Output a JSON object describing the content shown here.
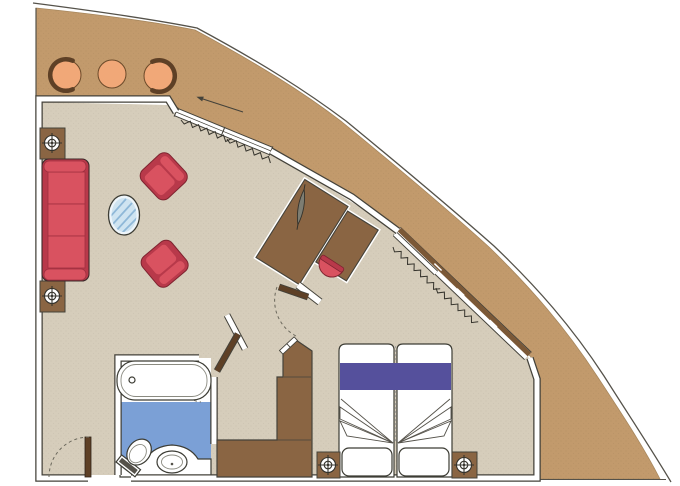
{
  "plan": {
    "kind": "suite-floor-plan",
    "rooms": [
      {
        "name": "balcony",
        "furniture": [
          "lounge-chair",
          "round-table",
          "lounge-chair"
        ]
      },
      {
        "name": "living-room",
        "furniture": [
          "sofa",
          "side-table-with-lamp",
          "side-table-with-lamp",
          "oval-glass-coffee-table",
          "armchair",
          "armchair"
        ]
      },
      {
        "name": "work-area",
        "furniture": [
          "desk-cabinet-unit",
          "tv",
          "desk-chair"
        ]
      },
      {
        "name": "bathroom",
        "furniture": [
          "bathtub",
          "toilet",
          "sink-vanity"
        ]
      },
      {
        "name": "bedroom",
        "furniture": [
          "double-bed",
          "pillow",
          "pillow",
          "nightstand-with-lamp",
          "nightstand-with-lamp",
          "wardrobe"
        ]
      }
    ],
    "openings": {
      "entry_door": "hinged",
      "bathroom_door": "hinged",
      "bedroom_door": "hinged",
      "wardrobe_door": "hinged",
      "balcony_door": "sliding-glass",
      "bedroom_window": "sliding-glass-with-sill"
    }
  },
  "colors": {
    "background": "#ffffff",
    "hull_deck": "#c29a6c",
    "hull_line": "#55524a",
    "interior_floor": "#d6cdbb",
    "wall_line": "#44423a",
    "wall_fill": "#ffffff",
    "bathroom_floor": "#7ba0d6",
    "wood": "#8a6543",
    "door_wood": "#5e4026",
    "window_sill": "#7b5836",
    "sofa_red": "#d95260",
    "sofa_red_dark": "#b8394a",
    "chair_orange": "#f1a878",
    "bed_purple": "#55509c",
    "glass_blue": "#cfe4f1",
    "glass_hatch": "#8fb8d8",
    "tv_gray": "#7d7d72",
    "fixture_white": "#ffffff"
  }
}
